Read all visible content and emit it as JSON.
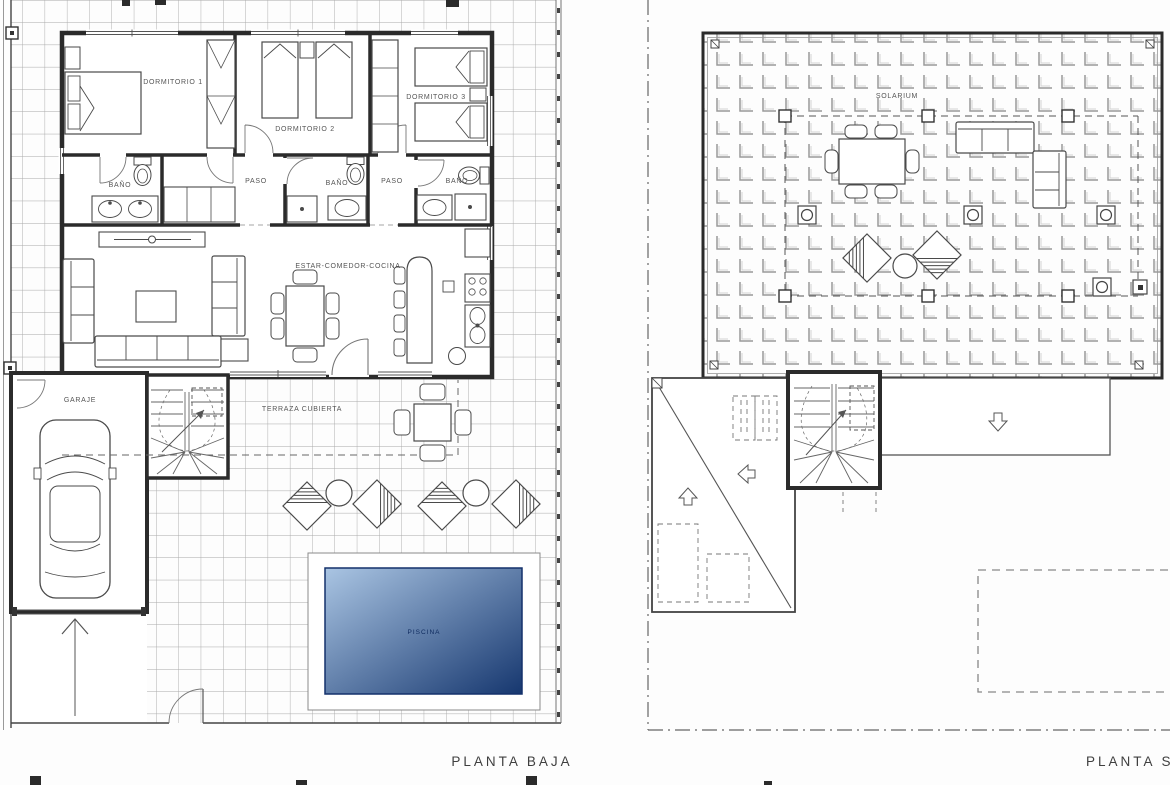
{
  "plans": {
    "ground_floor": {
      "title": "PLANTA BAJA",
      "rooms": {
        "bedroom1": "DORMITORIO 1",
        "bedroom2": "DORMITORIO 2",
        "bedroom3": "DORMITORIO 3",
        "bath1": "BAÑO",
        "bath2": "BAÑO",
        "bath3": "BAÑO",
        "hall1": "PASO",
        "hall2": "PASO",
        "living": "ESTAR-COMEDOR-COCINA",
        "garage": "GARAJE",
        "terrace": "TERRAZA CUBIERTA",
        "pool": "PISCINA"
      }
    },
    "solarium_floor": {
      "title": "PLANTA SOLA",
      "rooms": {
        "solarium": "SOLARIUM"
      }
    }
  },
  "colors": {
    "wall": "#2b2b2b",
    "grid_line": "#a8a8a8",
    "pool_light": "#aac5e3",
    "pool_dark": "#16376f",
    "pool_label": "#0e2a5e",
    "label_text": "#555555"
  }
}
